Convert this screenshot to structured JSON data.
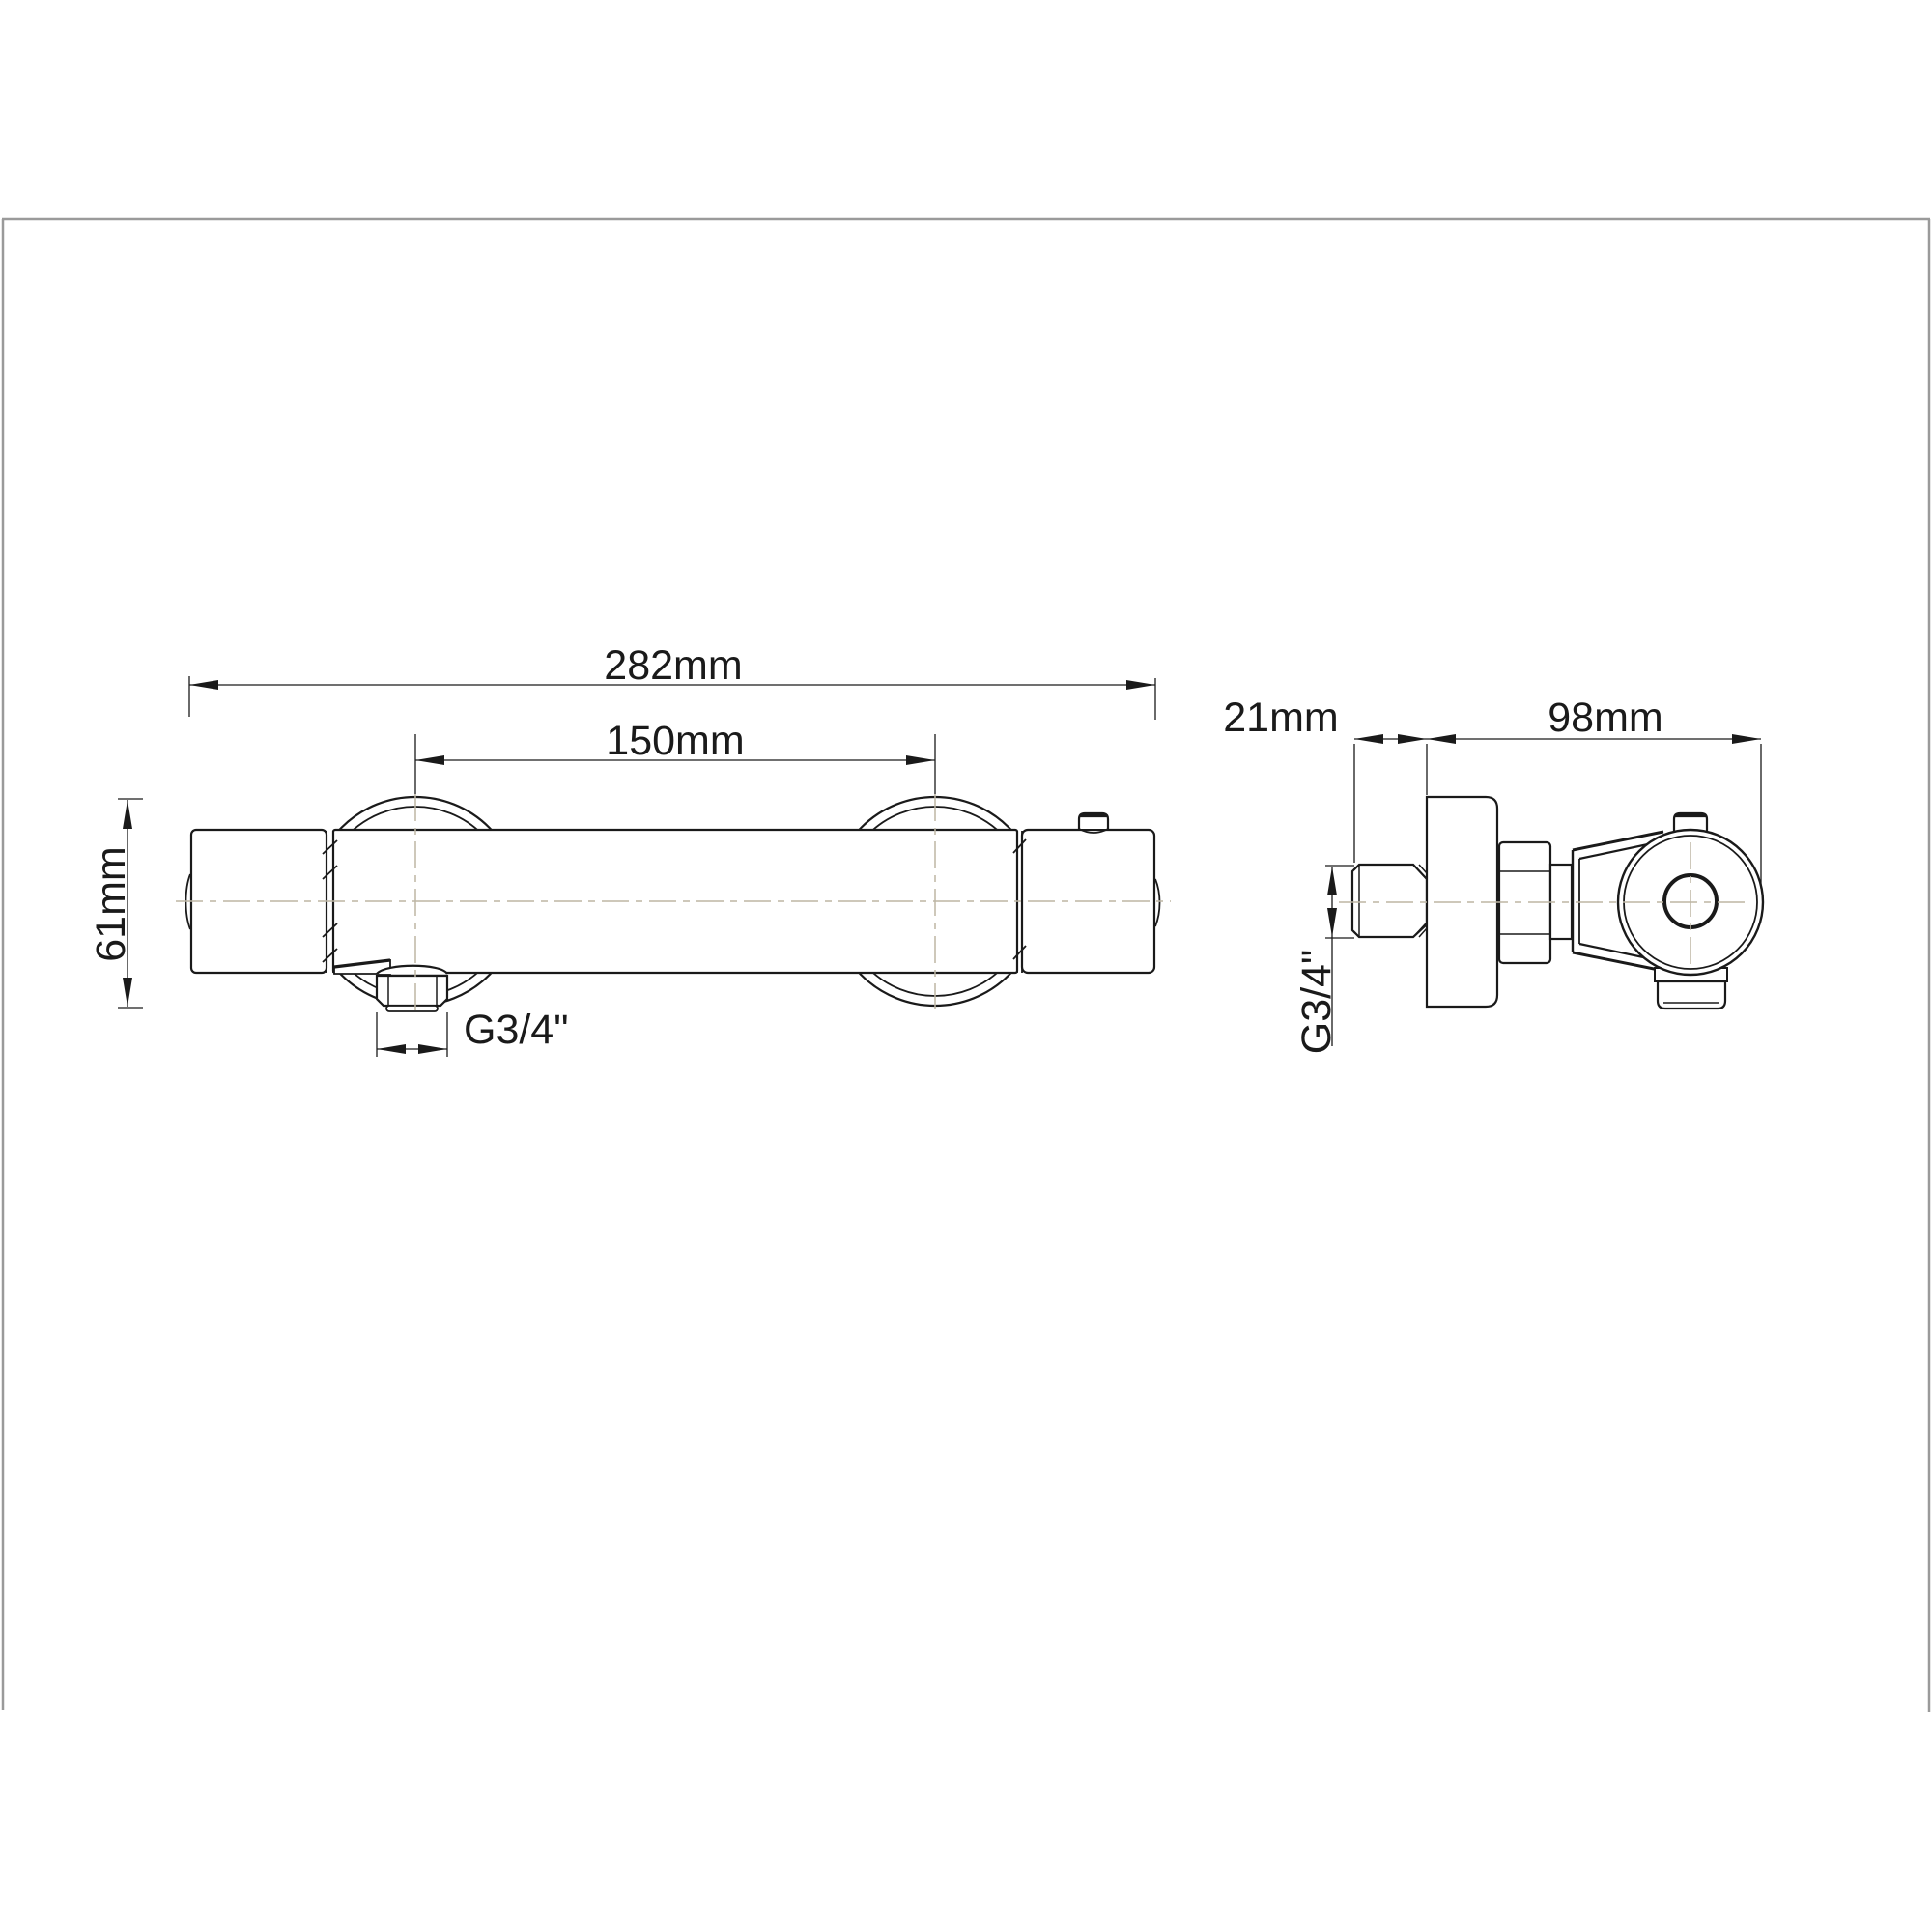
{
  "drawing": {
    "front_view": {
      "overall_width_label": "282mm",
      "hole_centers_label": "150mm",
      "escutcheon_diameter_label": "61mm",
      "outlet_thread_label": "G3/4\""
    },
    "side_view": {
      "nipple_length_label": "21mm",
      "depth_label": "98mm",
      "inlet_thread_label": "G3/4\""
    },
    "colors": {
      "line": "#1a1a1a",
      "centerline": "#bdb6a4",
      "frame": "#9a9a9a",
      "background": "#ffffff"
    }
  }
}
